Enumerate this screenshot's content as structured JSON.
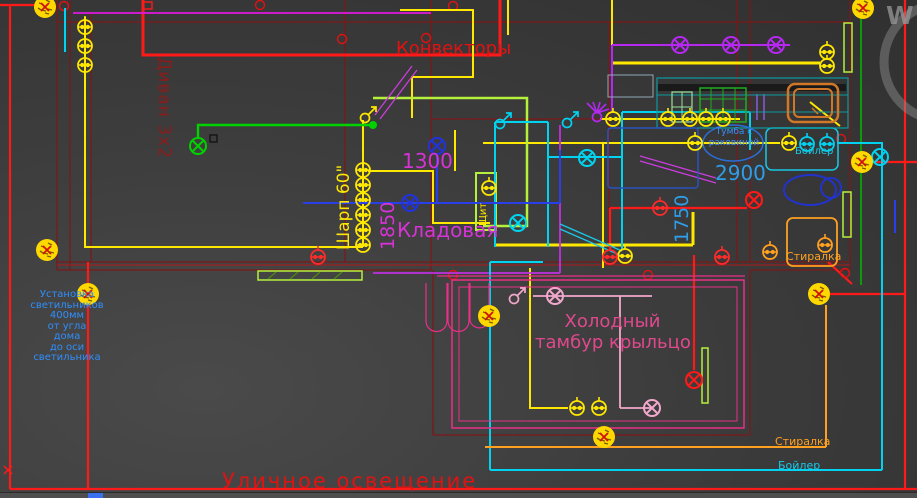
{
  "drawing": {
    "rooms": {
      "sofa_label": "Диван 3х2",
      "convectors_label": "Конвекторы",
      "tv_label": "Шарп 60\"",
      "storage_label": "Кладовая",
      "panel_label": "Щит",
      "sink_cabinet_label_line1": "Тумба с",
      "sink_cabinet_label_line2": "раковиной",
      "cold_vestibule_line1": "Холодный",
      "cold_vestibule_line2": "тамбур крыльцо"
    },
    "dimensions": {
      "d1300": "1300",
      "d1850": "1850",
      "d2900": "2900",
      "d1750": "1750"
    },
    "appliances": {
      "boiler_top": "Бойлер",
      "washer_top": "Стиралка",
      "washer_bottom": "Стиралка",
      "boiler_bottom": "Бойлер"
    },
    "notes": {
      "install_note_lines": [
        "Установка",
        "светильников",
        "400мм",
        "от угла",
        "дома",
        "до оси",
        "светильника"
      ],
      "street_lighting": "Уличное освещение"
    },
    "watermark": "W",
    "colors": {
      "background": "#3d3d3d",
      "walls_dark_red": "#7c1818",
      "power_red": "#ff1a1a",
      "wire_yellow": "#ffe800",
      "wire_cyan": "#00d2f0",
      "wire_blue": "#2a3fe8",
      "wire_green": "#00d200",
      "wire_chartreuse": "#b4f03c",
      "wire_purple": "#b428f0",
      "wire_orange": "#ffa020",
      "porch_pink": "#ea2f86",
      "light_pink": "#f2a8cc",
      "text_magenta": "#d633d6",
      "text_blue": "#2e8fff",
      "junction_yellow": "#ffd800"
    }
  }
}
